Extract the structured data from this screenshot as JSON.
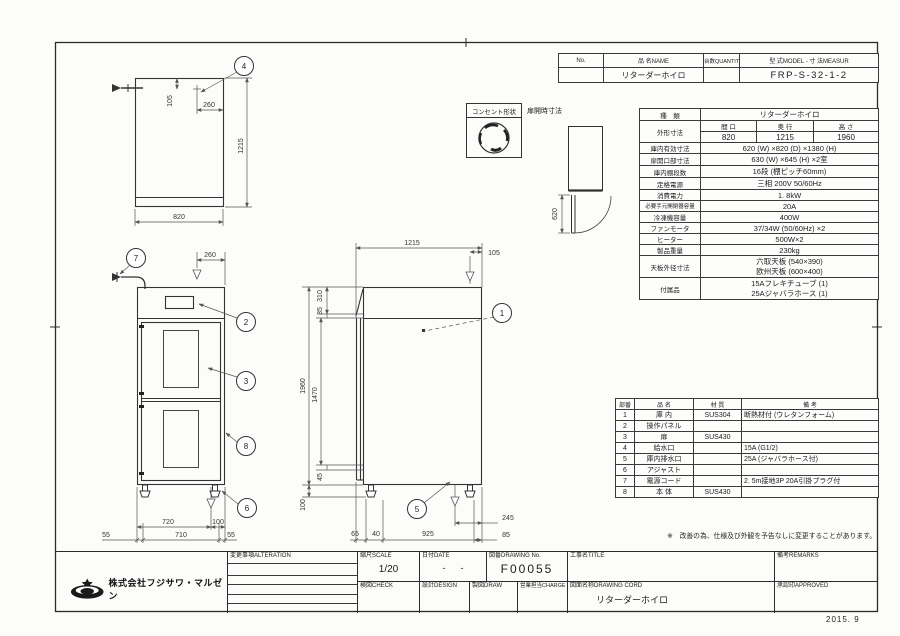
{
  "sheet": {
    "date_stamp": "2015. 9"
  },
  "title_table": {
    "no_label": "No.",
    "name_label": "品 名NAME",
    "qty_label": "台数QUANTITY",
    "model_label": "型 式MODEL - 寸 法MEASUR",
    "name_value": "リターダーホイロ",
    "model_value": "FRP-S-32-1-2"
  },
  "spec_table": {
    "kind_label": "種　類",
    "kind_value": "リターダーホイロ",
    "outer_label": "外形寸法",
    "w_label": "間 口",
    "d_label": "奥 行",
    "h_label": "高 さ",
    "w_value": "820",
    "d_value": "1215",
    "h_value": "1960",
    "rows": [
      {
        "label": "庫内有効寸法",
        "value": "620 (W) ×820 (D) ×1380 (H)"
      },
      {
        "label": "扉開口部寸法",
        "value": "630 (W) ×645 (H) ×2室"
      },
      {
        "label": "庫内棚段数",
        "value": "16段 (棚ピッチ60mm)"
      },
      {
        "label": "定格電源",
        "value": "三相  200V  50/60Hz"
      },
      {
        "label": "消費電力",
        "value": "1. 8kW"
      },
      {
        "label": "必要手元開閉器容量",
        "value": "20A"
      },
      {
        "label": "冷凍機容量",
        "value": "400W"
      },
      {
        "label": "ファンモータ",
        "value": "37/34W (50/60Hz) ×2"
      },
      {
        "label": "ヒーター",
        "value": "500W×2"
      },
      {
        "label": "製品重量",
        "value": "230kg"
      }
    ],
    "rows2": [
      {
        "label": "天板外径寸法",
        "line1": "六取天板 (540×390)",
        "line2": "欧州天板 (600×400)"
      },
      {
        "label": "付属品",
        "line1": "15Aフレキチューブ (1)",
        "line2": "25Aジャバラホース (1)"
      }
    ]
  },
  "parts_table": {
    "headers": [
      "部番",
      "品  名",
      "材  質",
      "備  考"
    ],
    "rows": [
      [
        "1",
        "庫 内",
        "SUS304",
        "断熱材付 (ウレタンフォーム)"
      ],
      [
        "2",
        "操作パネル",
        "",
        ""
      ],
      [
        "3",
        "扉",
        "SUS430",
        ""
      ],
      [
        "4",
        "給水口",
        "",
        "15A (G1/2)"
      ],
      [
        "5",
        "庫内排水口",
        "",
        "25A (ジャバラホース付)"
      ],
      [
        "6",
        "アジャスト",
        "",
        ""
      ],
      [
        "7",
        "電源コード",
        "",
        "2. 5m接地3P  20A引掛プラグ付"
      ],
      [
        "8",
        "本 体",
        "SUS430",
        ""
      ]
    ]
  },
  "note": "※　改善の為、仕様及び外観を予告なしに変更することがあります。",
  "title_block": {
    "company": "株式会社フジサワ・マルゼン",
    "alteration_label": "変更事項ALTERATION",
    "scale_label": "縮尺SCALE",
    "scale_value": "1/20",
    "date_label": "日付DATE",
    "date_value": "-      -",
    "dwgno_label": "図番DRAWING No.",
    "dwgno_value": "F00055",
    "title_label": "工事名TITLE",
    "remarks_label": "備考REMARKS",
    "check_label": "検図CHECK",
    "design_label": "設計DESIGN",
    "draw_label": "製図DRAW",
    "charge_label": "営業担当CHARGE",
    "dwgname_label": "図面名称DRAWING CORD",
    "dwgname_value": "リターダーホイロ",
    "approved_label": "承認印APPROVED"
  },
  "drawing": {
    "labels": {
      "outlet": "コンセント形状",
      "door_open": "扉開時寸法"
    },
    "balloons": {
      "b1": "1",
      "b2": "2",
      "b3": "3",
      "b4": "4",
      "b5": "5",
      "b6": "6",
      "b7": "7",
      "b8": "8"
    },
    "plan": {
      "d105": "105",
      "d260": "260",
      "d1215": "1215",
      "d820": "820"
    },
    "door": {
      "d620": "620"
    },
    "front": {
      "d260": "260",
      "d720": "720",
      "d100": "100",
      "d55l": "55",
      "d710": "710",
      "d55r": "55"
    },
    "side": {
      "d1215": "1215",
      "d105": "105",
      "d310": "310",
      "d35": "35",
      "d1960": "1960",
      "d1470": "1470",
      "d45": "45",
      "d100": "100",
      "d65": "65",
      "d40": "40",
      "d925": "925",
      "d245": "245",
      "d85": "85"
    }
  }
}
